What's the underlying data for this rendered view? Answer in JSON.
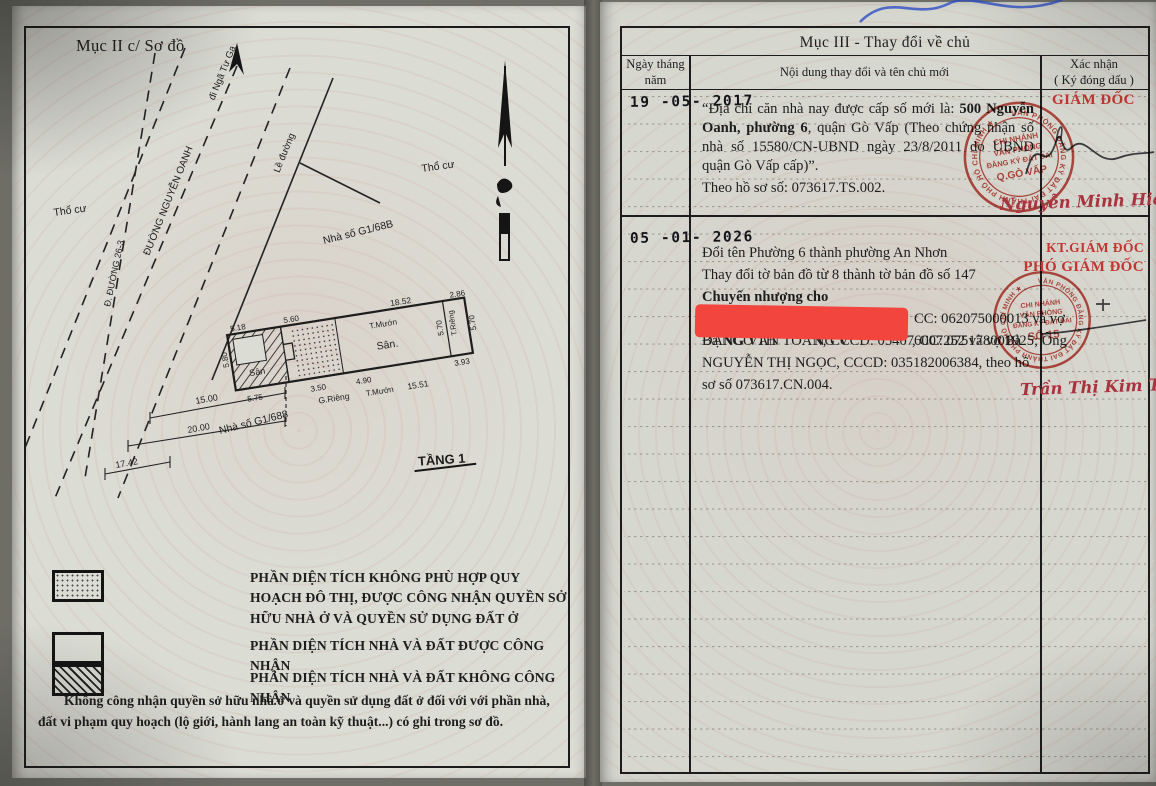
{
  "left_page": {
    "section_title": "Mục II c/ Sơ đồ",
    "diagram": {
      "street_name": "ĐƯỜNG NGUYỄN OANH",
      "street_direction": "đi Ngã Tư Ga",
      "curb_label": "Lề đường",
      "boundary_line_label": "Đ. ĐƯỜNG 26-3",
      "land_use_left": "Thổ cư",
      "land_use_right": "Thổ cư",
      "house_number_top": "Nhà số G1/68B",
      "house_number_bottom": "Nhà số G1/688",
      "floor_label": "TẦNG 1",
      "plot": {
        "yard_left": "Sân",
        "yard_right": "Sân.",
        "wall_top": "T.Mướn",
        "wall_bottom": "T.Mướn",
        "wall_right": "T.Riêng",
        "well_label": "G.Riêng",
        "dim_top_1": "5.18",
        "dim_top_2": "5.60",
        "dim_top_right": "18.52",
        "dim_left_vert": "5.80",
        "dim_mid_vert": "5.70",
        "dim_right_vert": "5.70",
        "dim_end_top": "2.86",
        "dim_end_bottom": "3.93",
        "dim_bottom_1": "5.75",
        "dim_bottom_2": "3.50",
        "dim_bottom_3": "4.90",
        "dim_bottom_4": "15.51"
      },
      "setback_dims": {
        "d1": "15.00",
        "d2": "20.00",
        "d3": "17.42"
      }
    },
    "legend": {
      "item1": "PHẦN DIỆN TÍCH KHÔNG PHÙ HỢP QUY HOẠCH ĐÔ THỊ, ĐƯỢC CÔNG NHẬN QUYỀN SỞ HỮU NHÀ Ở VÀ QUYỀN SỬ DỤNG ĐẤT Ở",
      "item2": "PHẦN DIỆN TÍCH NHÀ VÀ ĐẤT ĐƯỢC CÔNG NHẬN",
      "item3": "PHẦN DIỆN TÍCH NHÀ VÀ ĐẤT KHÔNG CÔNG NHẬN"
    },
    "footnote": "Không công nhận quyền sở hữu nhà ở và quyền sử dụng đất ở đối với với phần nhà, đất vi phạm quy hoạch (lộ giới, hành lang an toàn kỹ thuật...) có ghi trong sơ đồ."
  },
  "right_page": {
    "section_title": "Mục III - Thay đổi về chủ",
    "columns": {
      "date": "Ngày tháng năm",
      "content": "Nội dung thay đổi và tên chủ mới",
      "confirm_line1": "Xác nhận",
      "confirm_line2": "( Ký đóng dấu )"
    },
    "entry1": {
      "date": "19 -05- 2017",
      "text_normal_1": "“Địa chỉ căn nhà nay được cấp số mới là: ",
      "text_bold": "500 Nguyễn Oanh, phường 6",
      "text_normal_2": ", quận Gò Vấp (Theo chứng nhận số nhà số 15580/CN-UBND ngày 23/8/2011 do UBND quận Gò Vấp cấp)”.",
      "file_ref": "Theo hồ sơ số: 073617.TS.002.",
      "approver_title": "GIÁM ĐỐC",
      "approver_name": "Nguyễn Minh Hiếu",
      "stamp": {
        "ring": "VĂN PHÒNG ĐĂNG KÝ ĐẤT ĐAI THÀNH PHỐ HỒ CHÍ MINH ★",
        "line1": "CHI NHÁNH",
        "line2": "VĂN PHÒNG",
        "line3": "ĐĂNG KÝ ĐẤT ĐAI",
        "line4": "Q.GÒ VẤP"
      }
    },
    "entry2": {
      "date": "05 -01- 2026",
      "line1": "Đổi tên Phường 6 thành phường An Nhơn",
      "line2": "Thay đổi tờ bản đồ từ 8 thành tờ bản đồ số 147",
      "line3": "Chuyển nhượng cho",
      "line4_visible": "CC: 062075000013 và vợ",
      "line5_fragment1": "Bà NGÔ TH",
      "line5_fragment2": "NG V",
      "line5_visible": ", CC: 075178001925; Ông",
      "line6": "ĐẶNG VĂN TOÀN, CCCD: 054076007252 và vợ Bà",
      "line7": "NGUYỄN THỊ NGỌC, CCCD: 035182006384, theo hồ",
      "line8": "sơ số 073617.CN.004.",
      "approver_title_1": "KT.GIÁM ĐỐC",
      "approver_title_2": "PHÓ GIÁM ĐỐC",
      "approver_name": "Trần Thị Kim Tịnh",
      "stamp": {
        "ring": "VĂN PHÒNG ĐĂNG KÝ ĐẤT ĐAI THÀNH PHỐ HỒ CHÍ MINH ★",
        "line1": "CHI NHÁNH",
        "line2": "VĂN PHÒNG",
        "line3": "ĐĂNG KÝ ĐẤT ĐAI",
        "line4": "SỐ 15"
      }
    }
  },
  "colors": {
    "stamp_red": "#bf3a31",
    "signature_red": "#a8333e",
    "redaction_red": "#f2453d",
    "ink_black": "#1d1d1d",
    "handwriting_blue": "#2d4fc4",
    "paper": "#d8d9d1"
  }
}
